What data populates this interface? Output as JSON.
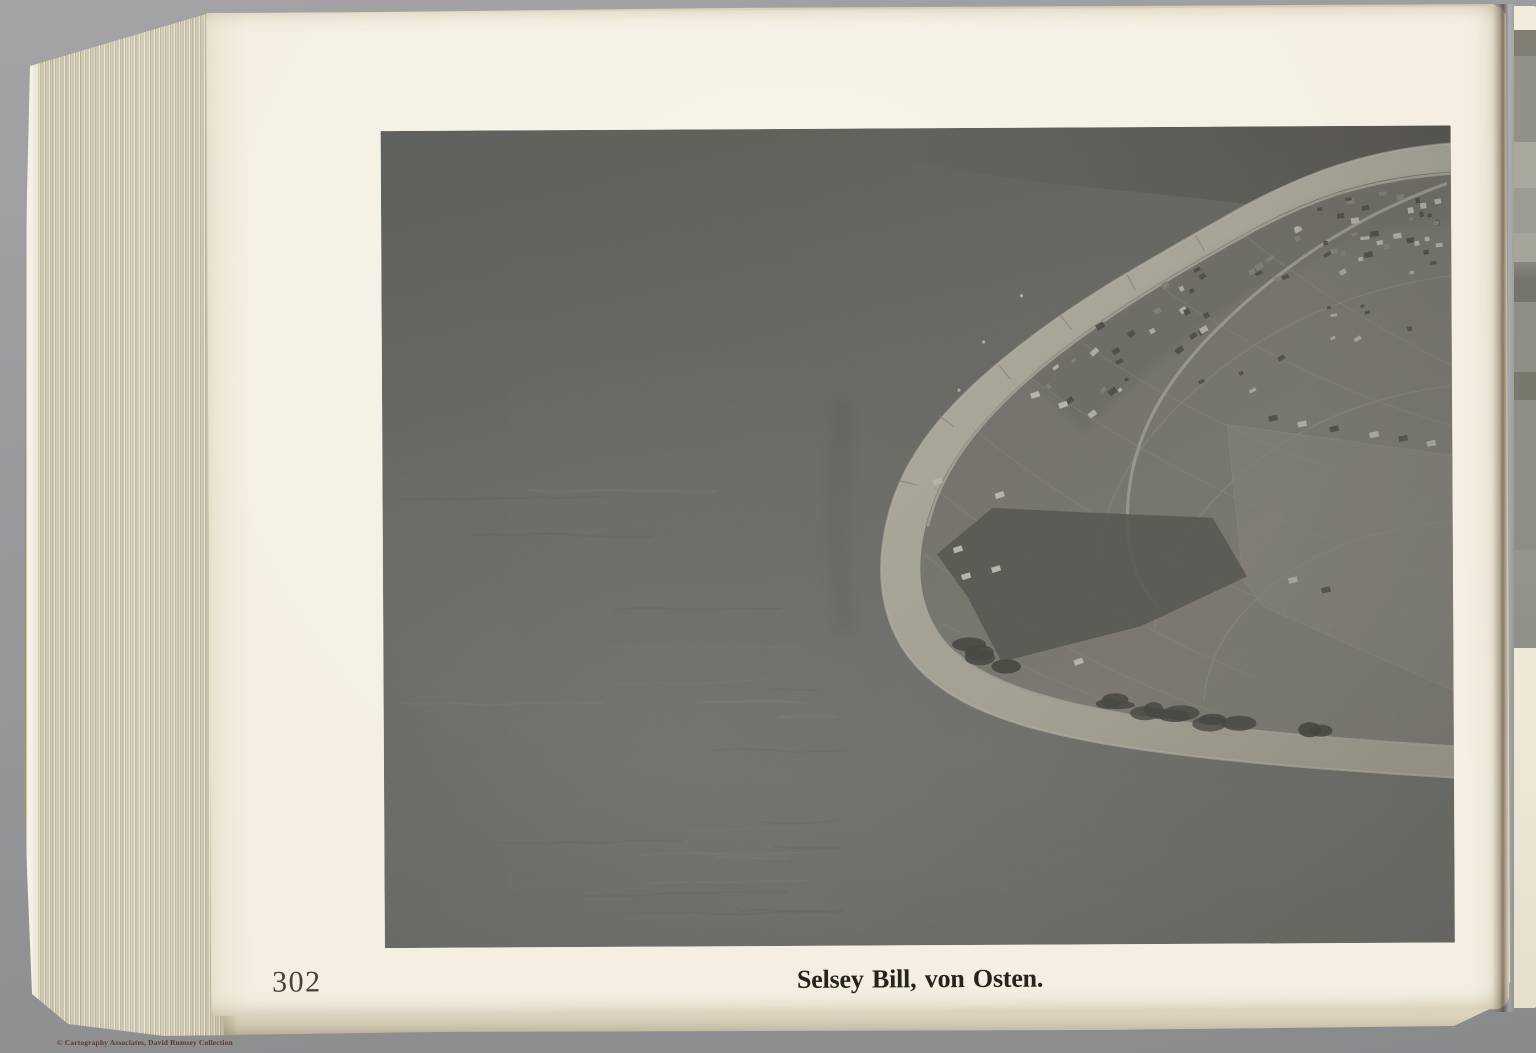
{
  "page": {
    "number": "302",
    "caption": "Selsey Bill, von Osten."
  },
  "watermark": {
    "text": "© Cartography Associates, David Rumsey Collection"
  },
  "photo": {
    "description": "Black-and-white oblique aerial photograph of Selsey Bill seen from the east: a light curving shingle beach wraps around a low headland with the town, roads and fields of Selsey on the land side, dark sea filling the left, top and foreground"
  },
  "colors": {
    "scanner_background": "#97979a",
    "page_paper": "#f4efe2",
    "photo_sea": "#6f6f68",
    "photo_beach": "#bcb9a8",
    "photo_land": "#7e7c72",
    "ink": "#26231d",
    "watermark_ink": "#5c2e24"
  }
}
